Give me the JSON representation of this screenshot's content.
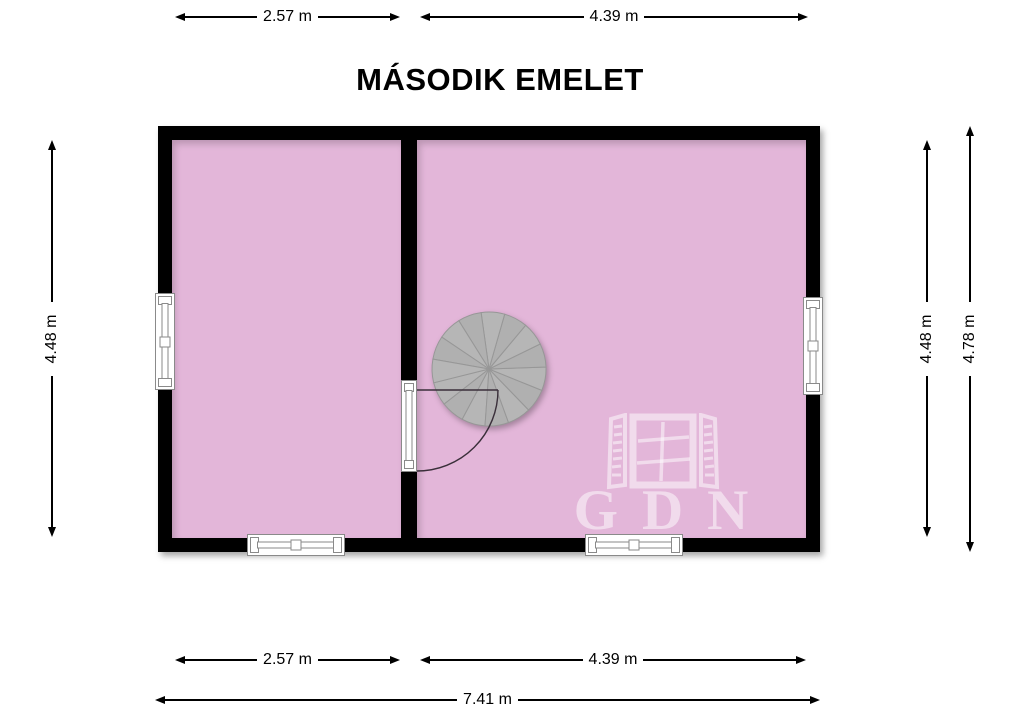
{
  "title": "MÁSODIK EMELET",
  "watermark": {
    "text": "GDN",
    "icon": "open-window-icon"
  },
  "dimensions": {
    "top": [
      "2.57 m",
      "4.39 m"
    ],
    "left": "4.48 m",
    "right_inner": "4.48 m",
    "right_outer": "4.78 m",
    "bottom": [
      "2.57 m",
      "4.39 m"
    ],
    "overall_width": "7.41 m"
  },
  "plan": {
    "rooms": 2,
    "features": [
      "spiral-staircase",
      "interior-door",
      "window-left-wall",
      "window-right-wall",
      "window-bottom-left",
      "window-bottom-right"
    ]
  },
  "colors": {
    "floor": "#e3b6d9",
    "wall": "#000000",
    "staircase": "#b4b4b4",
    "dimension_lines": "#000000",
    "watermark": "rgba(255,255,255,0.5)"
  }
}
